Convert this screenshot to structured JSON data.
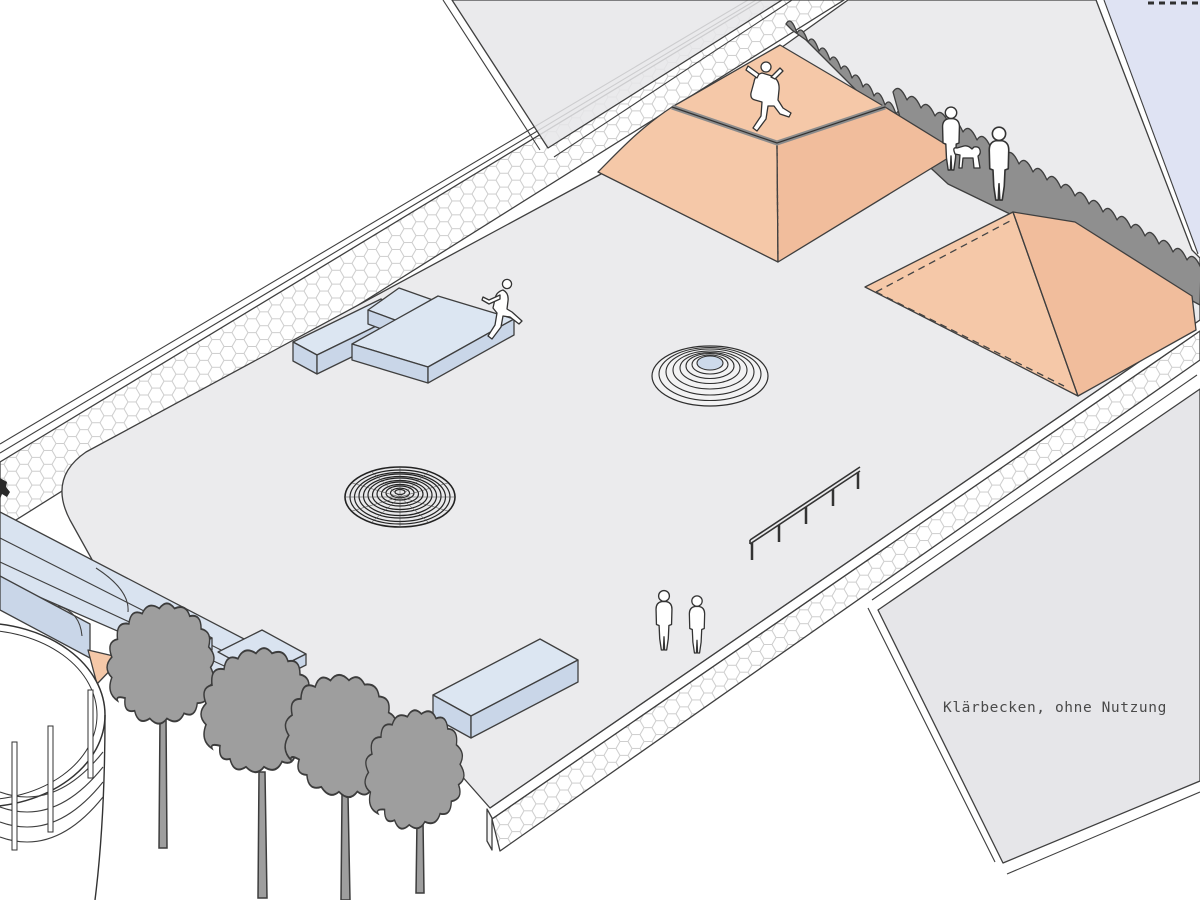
{
  "annotation": {
    "basin_label": "Klärbecken, ohne Nutzung"
  },
  "colors": {
    "ramp": "#f5c8a8",
    "ramp_shade": "#f1bd9c",
    "ledge_top": "#dce6f2",
    "ledge_side": "#c9d6e8",
    "bank_top": "#d9e3f0",
    "ground": "#ebebed",
    "basin": "#e6e6e9",
    "water": "#dfe3f3",
    "tree": "#9e9e9e",
    "bush": "#8f8f8f",
    "outline": "#3f3f3f",
    "dome_top": "#cddaeb"
  },
  "figures": {
    "skater_pyramid": "skater-doing-trick-on-pyramid",
    "skater_ledge": "skater-grinding-ledge",
    "pedestrian_pair": "two-pedestrians-standing",
    "family": "two-adults-with-dog"
  },
  "scene": {
    "kind": "axonometric skatepark illustration on disused clarifier plant"
  }
}
